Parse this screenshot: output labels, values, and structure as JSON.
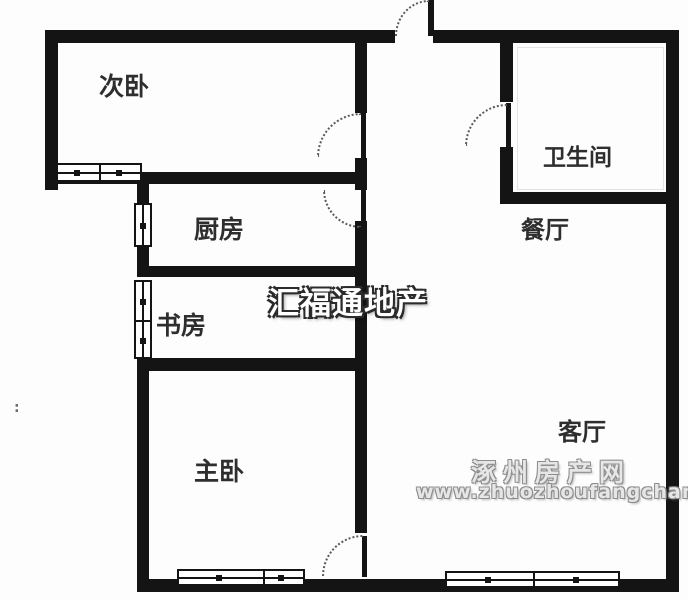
{
  "floorplan": {
    "rooms": {
      "secondary_bedroom": "次卧",
      "kitchen": "厨房",
      "study": "书房",
      "master_bedroom": "主卧",
      "bathroom": "卫生间",
      "dining_room": "餐厅",
      "living_room": "客厅"
    },
    "watermarks": {
      "agency": "汇福通地产",
      "site_name": "涿州房产网",
      "site_url": "www.zhuozhoufangchan.com"
    },
    "stray_mark": ":",
    "colors": {
      "wall": "#141414",
      "label_text": "#2e2e2e",
      "agency_watermark_fill": "#ffffff",
      "site_watermark_fill": "#e6e6e6",
      "watermark_outline": "#8d8d8d",
      "background": "#fdfdfd"
    }
  }
}
